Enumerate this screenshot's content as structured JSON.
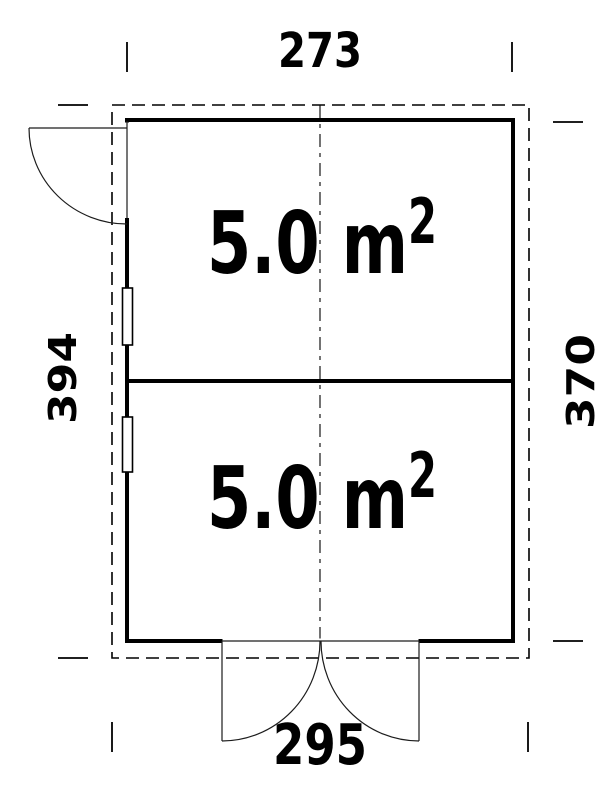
{
  "floor_plan": {
    "type": "floor-plan",
    "dimension_labels": {
      "top_width": "273",
      "left_height": "394",
      "right_height": "370",
      "bottom_width": "295"
    },
    "rooms": [
      {
        "position": "upper",
        "area_text": "5.0 m",
        "area_superscript": "2"
      },
      {
        "position": "lower",
        "area_text": "5.0 m",
        "area_superscript": "2"
      }
    ],
    "colors": {
      "line": "#000000",
      "background": "#ffffff"
    }
  }
}
